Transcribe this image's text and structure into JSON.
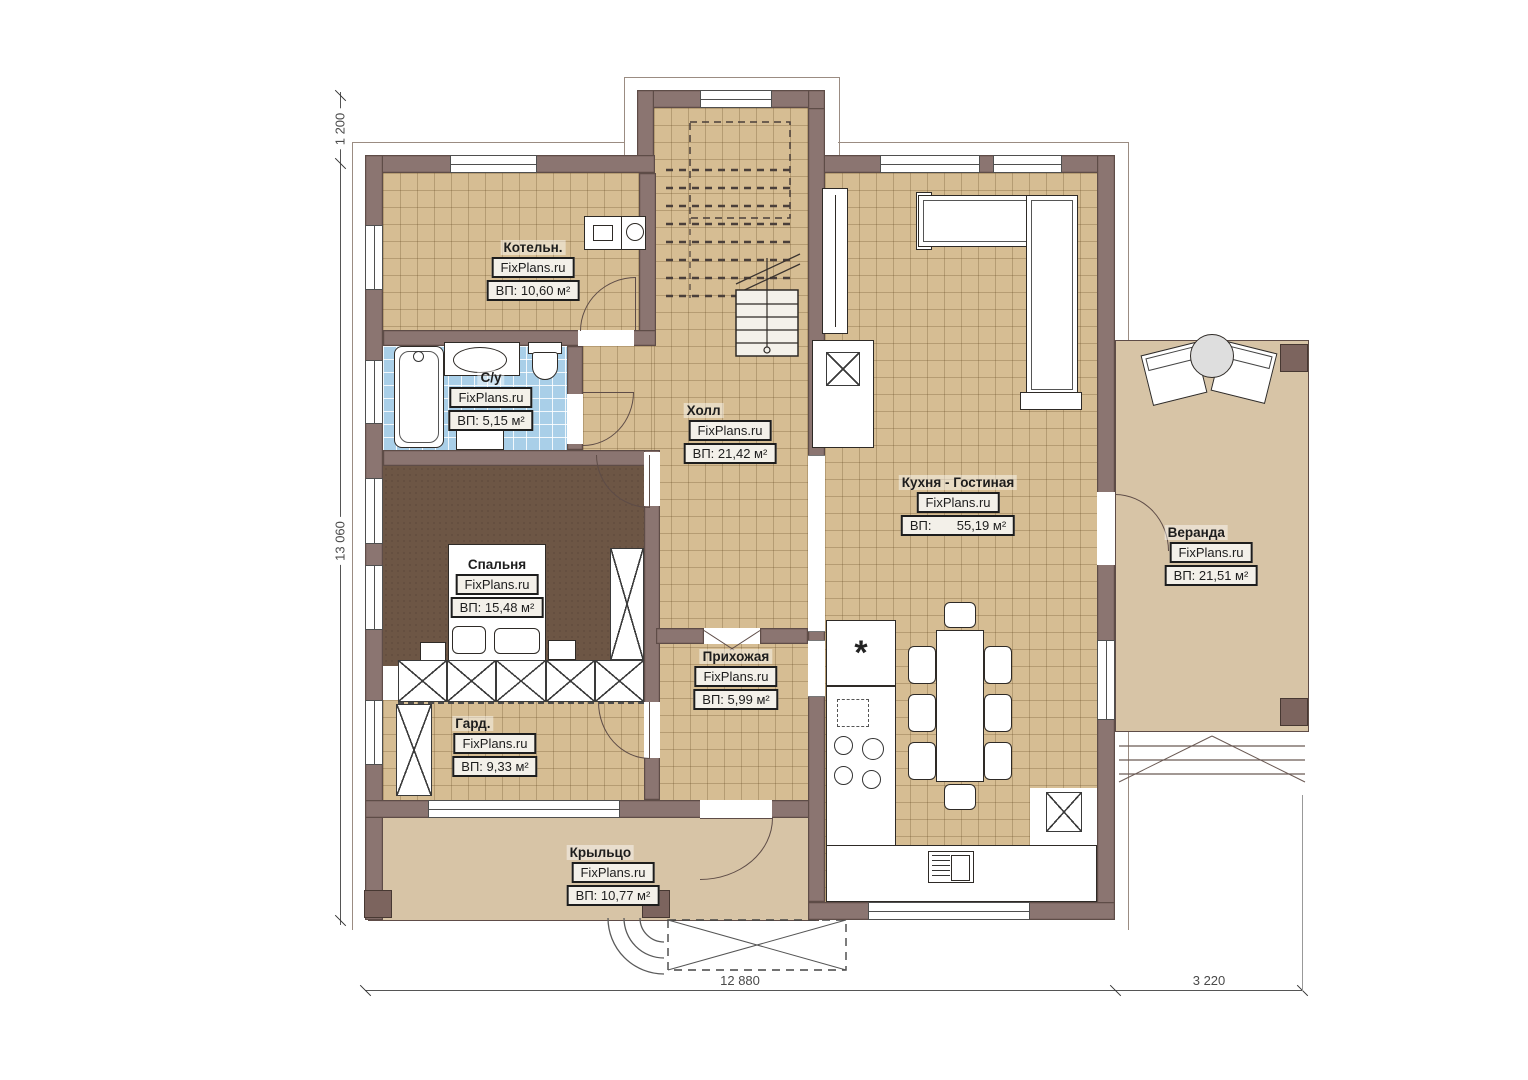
{
  "branding": {
    "site": "FixPlans.ru"
  },
  "rooms": [
    {
      "id": "boiler",
      "name": "Котельн.",
      "area": "ВП: 10,60 м²"
    },
    {
      "id": "bathroom",
      "name": "С/у",
      "area": "ВП: 5,15 м²"
    },
    {
      "id": "hall",
      "name": "Холл",
      "area": "ВП: 21,42 м²"
    },
    {
      "id": "bedroom",
      "name": "Спальня",
      "area": "ВП: 15,48 м²"
    },
    {
      "id": "wardrobe",
      "name": "Гард.",
      "area": "ВП: 9,33 м²"
    },
    {
      "id": "entry",
      "name": "Прихожая",
      "area": "ВП: 5,99 м²"
    },
    {
      "id": "kitchen",
      "name": "Кухня - Гостиная",
      "area": "ВП:       55,19 м²"
    },
    {
      "id": "veranda",
      "name": "Веранда",
      "area": "ВП: 21,51 м²"
    },
    {
      "id": "porch",
      "name": "Крыльцо",
      "area": "ВП: 10,77 м²"
    }
  ],
  "dimensions": {
    "top_offset": "1 200",
    "left_height": "13 060",
    "bottom_width": "12 880",
    "veranda_width": "3 220"
  },
  "symbols": {
    "fridge": "*"
  },
  "colors": {
    "wall": "#8b7571",
    "wall-outline": "#5e4c47",
    "tile": "#d6bd93",
    "tile-line": "rgba(107,78,40,0.30)",
    "bath-tile": "#a9cfe8",
    "bedroom-floor": "#6d5645",
    "deck": "#d7c4a6",
    "label-bg": "#f3f0e9",
    "ink": "#1d1d1d",
    "dim": "#4a4a4a"
  }
}
